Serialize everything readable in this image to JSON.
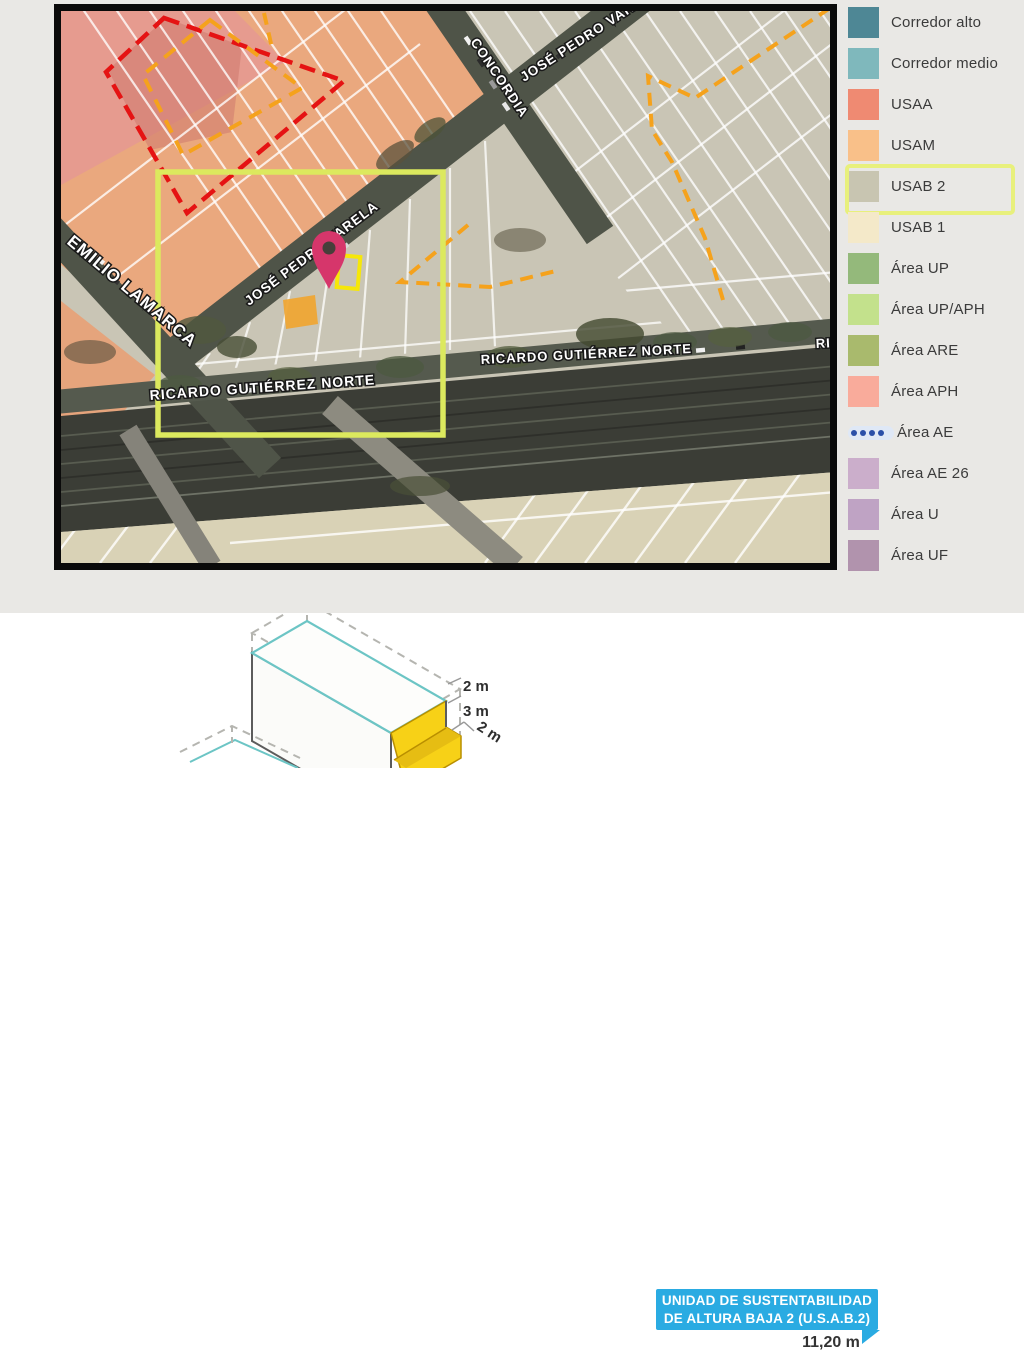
{
  "legend": {
    "highlight_label": "USAB 2",
    "highlight_color": "#e8f07c",
    "items": [
      {
        "label": "Corredor alto",
        "color": "#4e8795",
        "type": "swatch"
      },
      {
        "label": "Corredor medio",
        "color": "#7fb8bc",
        "type": "swatch"
      },
      {
        "label": "USAA",
        "color": "#ef8a72",
        "type": "swatch"
      },
      {
        "label": "USAM",
        "color": "#f9c089",
        "type": "swatch"
      },
      {
        "label": "USAB 2",
        "color": "#c8c5b1",
        "type": "swatch",
        "highlighted": true
      },
      {
        "label": "USAB 1",
        "color": "#f4e9c9",
        "type": "swatch"
      },
      {
        "label": "Área UP",
        "color": "#94b97b",
        "type": "swatch"
      },
      {
        "label": "Área UP/APH",
        "color": "#c3e18c",
        "type": "swatch"
      },
      {
        "label": "Área ARE",
        "color": "#a9ba6d",
        "type": "swatch"
      },
      {
        "label": "Área APH",
        "color": "#f9ab9b",
        "type": "swatch"
      },
      {
        "label": "Área AE",
        "color": "#2a4fa8",
        "type": "dots"
      },
      {
        "label": "Área AE 26",
        "color": "#cbaecb",
        "type": "swatch"
      },
      {
        "label": "Área U",
        "color": "#bfa3c4",
        "type": "swatch"
      },
      {
        "label": "Área UF",
        "color": "#b193ad",
        "type": "swatch"
      }
    ]
  },
  "map": {
    "labels": {
      "emilio_lamarca": "EMILIO LAMARCA",
      "concordia": "CONCORDIA",
      "jose_pedro_varela": "JOSÉ PEDRO VARELA",
      "ricardo_gutierrez": "RICARDO GUTIÉRREZ NORTE"
    },
    "colors": {
      "selection_rect": "#dce95e",
      "lot_outline": "#f6e70a",
      "highlight_parcel": "#efa735",
      "pin": "#d6366b",
      "overlay_red": "#e51313",
      "overlay_orange": "#f5a21c",
      "block_usam": "#eaa87e",
      "block_usab2": "#c9c5b5"
    }
  },
  "diagram": {
    "dim_top": "2 m",
    "dim_mid": "3 m",
    "dim_bottom": "2 m",
    "callout_line1": "UNIDAD DE SUSTENTABILIDAD",
    "callout_line2": "DE ALTURA BAJA 2 (U.S.A.B.2)",
    "callout_color": "#2aabe2",
    "total_height": "11,20 m",
    "face_color": "#f7d117",
    "edge_color": "#6cc5c5"
  }
}
